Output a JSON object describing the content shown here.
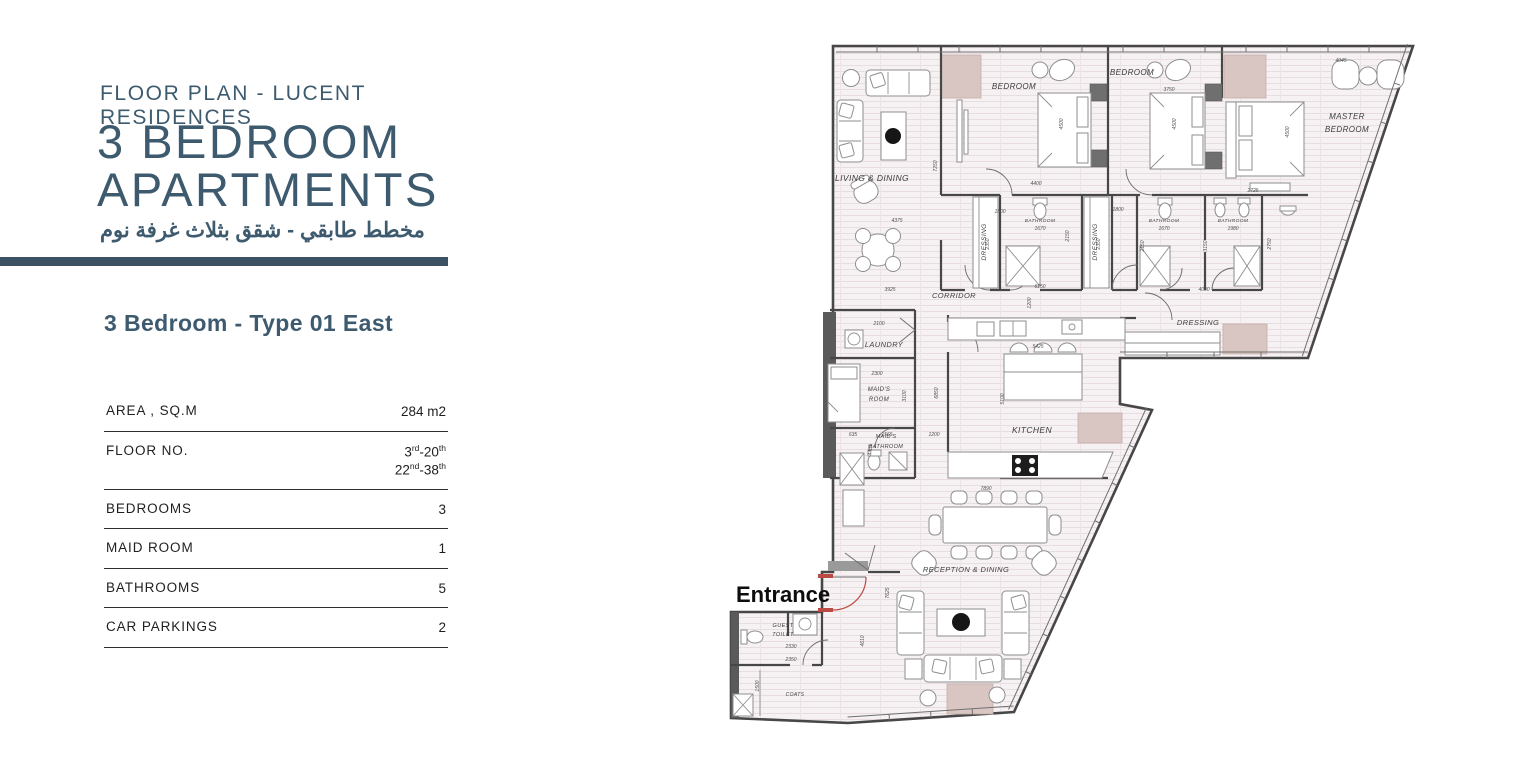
{
  "panel": {
    "eyebrow": "FLOOR PLAN - LUCENT RESIDENCES",
    "title_lines": [
      "3 BEDROOM",
      "APARTMENTS"
    ],
    "subtitle_ar": "مخطط طابقي - شقق بثلاث غرفة نوم",
    "type_title": "3 Bedroom - Type 01 East",
    "specs": [
      {
        "label": "AREA , SQ.M",
        "values": [
          "284 m2"
        ]
      },
      {
        "label": "FLOOR NO.",
        "values": [
          "3rd-20th",
          "22nd-38th"
        ]
      },
      {
        "label": "BEDROOMS",
        "values": [
          "3"
        ]
      },
      {
        "label": "MAID ROOM",
        "values": [
          "1"
        ]
      },
      {
        "label": "BATHROOMS",
        "values": [
          "5"
        ]
      },
      {
        "label": "CAR PARKINGS",
        "values": [
          "2"
        ]
      }
    ]
  },
  "colors": {
    "accent": "#3d5a6e",
    "bar": "#3a5264",
    "pink_block": "#d9c6c2",
    "entrance_red": "#bb4a42",
    "wall": "#474747",
    "floor": "#f6f1f3"
  },
  "floor_plan": {
    "entrance_label": {
      "t": "Entrance",
      "x": 736,
      "y": 602,
      "s": 22
    },
    "room_labels": [
      {
        "t": "LIVING & DINING",
        "x": 872,
        "y": 181,
        "s": 8.5
      },
      {
        "t": "BEDROOM",
        "x": 1014,
        "y": 89,
        "s": 8
      },
      {
        "t": "BEDROOM",
        "x": 1132,
        "y": 75,
        "s": 8
      },
      {
        "t": "MASTER",
        "x": 1347,
        "y": 119,
        "s": 8
      },
      {
        "t": "BEDROOM",
        "x": 1347,
        "y": 132,
        "s": 8
      },
      {
        "t": "DRESSING",
        "x": 986,
        "y": 242,
        "s": 6.5,
        "v": 1
      },
      {
        "t": "DRESSING",
        "x": 1097,
        "y": 242,
        "s": 6.5,
        "v": 1
      },
      {
        "t": "BATHROOM",
        "x": 1040,
        "y": 222,
        "s": 4.8
      },
      {
        "t": "BATHROOM",
        "x": 1164,
        "y": 222,
        "s": 4.8
      },
      {
        "t": "BATHROOM",
        "x": 1233,
        "y": 222,
        "s": 4.8
      },
      {
        "t": "CORRIDOR",
        "x": 954,
        "y": 298,
        "s": 7.5
      },
      {
        "t": "DRESSING",
        "x": 1198,
        "y": 325,
        "s": 7.5
      },
      {
        "t": "LAUNDRY",
        "x": 884,
        "y": 347,
        "s": 7.5
      },
      {
        "t": "MAID'S",
        "x": 879,
        "y": 391,
        "s": 6
      },
      {
        "t": "ROOM",
        "x": 879,
        "y": 401,
        "s": 6
      },
      {
        "t": "MAID'S",
        "x": 886,
        "y": 438,
        "s": 5.5
      },
      {
        "t": "BATHROOM",
        "x": 886,
        "y": 448,
        "s": 5.5
      },
      {
        "t": "KITCHEN",
        "x": 1032,
        "y": 433,
        "s": 8.5
      },
      {
        "t": "RECEPTION & DINING",
        "x": 966,
        "y": 572,
        "s": 7.5
      },
      {
        "t": "GUEST",
        "x": 783,
        "y": 627,
        "s": 5.5
      },
      {
        "t": "TOILET",
        "x": 783,
        "y": 636,
        "s": 5.5
      },
      {
        "t": "COATS",
        "x": 795,
        "y": 696,
        "s": 5
      }
    ],
    "dimensions": [
      {
        "t": "4375",
        "x": 897,
        "y": 222
      },
      {
        "t": "3925",
        "x": 890,
        "y": 291
      },
      {
        "t": "7250",
        "x": 937,
        "y": 166,
        "v": 1
      },
      {
        "t": "4400",
        "x": 1036,
        "y": 185
      },
      {
        "t": "4500",
        "x": 1063,
        "y": 124,
        "v": 1
      },
      {
        "t": "1800",
        "x": 1000,
        "y": 213
      },
      {
        "t": "2350",
        "x": 989,
        "y": 244,
        "v": 1
      },
      {
        "t": "1670",
        "x": 1040,
        "y": 230
      },
      {
        "t": "2150",
        "x": 1069,
        "y": 236,
        "v": 1
      },
      {
        "t": "6150",
        "x": 1040,
        "y": 288
      },
      {
        "t": "1200",
        "x": 1031,
        "y": 303,
        "v": 1
      },
      {
        "t": "3750",
        "x": 1169,
        "y": 91
      },
      {
        "t": "4500",
        "x": 1176,
        "y": 124,
        "v": 1
      },
      {
        "t": "1800",
        "x": 1118,
        "y": 211
      },
      {
        "t": "2350",
        "x": 1100,
        "y": 244,
        "v": 1
      },
      {
        "t": "1670",
        "x": 1164,
        "y": 230
      },
      {
        "t": "1980",
        "x": 1233,
        "y": 230
      },
      {
        "t": "2150",
        "x": 1144,
        "y": 246,
        "v": 1
      },
      {
        "t": "3150",
        "x": 1207,
        "y": 246,
        "v": 1
      },
      {
        "t": "2750",
        "x": 1271,
        "y": 244,
        "v": 1
      },
      {
        "t": "2725",
        "x": 1253,
        "y": 192
      },
      {
        "t": "4500",
        "x": 1289,
        "y": 132,
        "v": 1
      },
      {
        "t": "4045",
        "x": 1341,
        "y": 62
      },
      {
        "t": "4000",
        "x": 1204,
        "y": 291
      },
      {
        "t": "2100",
        "x": 879,
        "y": 325
      },
      {
        "t": "2300",
        "x": 877,
        "y": 375
      },
      {
        "t": "3100",
        "x": 906,
        "y": 396,
        "v": 1
      },
      {
        "t": "635",
        "x": 853,
        "y": 436
      },
      {
        "t": "1565",
        "x": 887,
        "y": 436
      },
      {
        "t": "1200",
        "x": 934,
        "y": 436
      },
      {
        "t": "4485",
        "x": 872,
        "y": 450,
        "v": 1
      },
      {
        "t": "5425",
        "x": 1038,
        "y": 348
      },
      {
        "t": "5100",
        "x": 1004,
        "y": 399,
        "v": 1
      },
      {
        "t": "6850",
        "x": 938,
        "y": 393,
        "v": 1
      },
      {
        "t": "7890",
        "x": 986,
        "y": 490
      },
      {
        "t": "7625",
        "x": 889,
        "y": 593,
        "v": 1
      },
      {
        "t": "4610",
        "x": 864,
        "y": 641,
        "v": 1
      },
      {
        "t": "2330",
        "x": 791,
        "y": 648
      },
      {
        "t": "2350",
        "x": 791,
        "y": 661
      },
      {
        "t": "1500",
        "x": 759,
        "y": 686,
        "v": 1
      }
    ]
  }
}
